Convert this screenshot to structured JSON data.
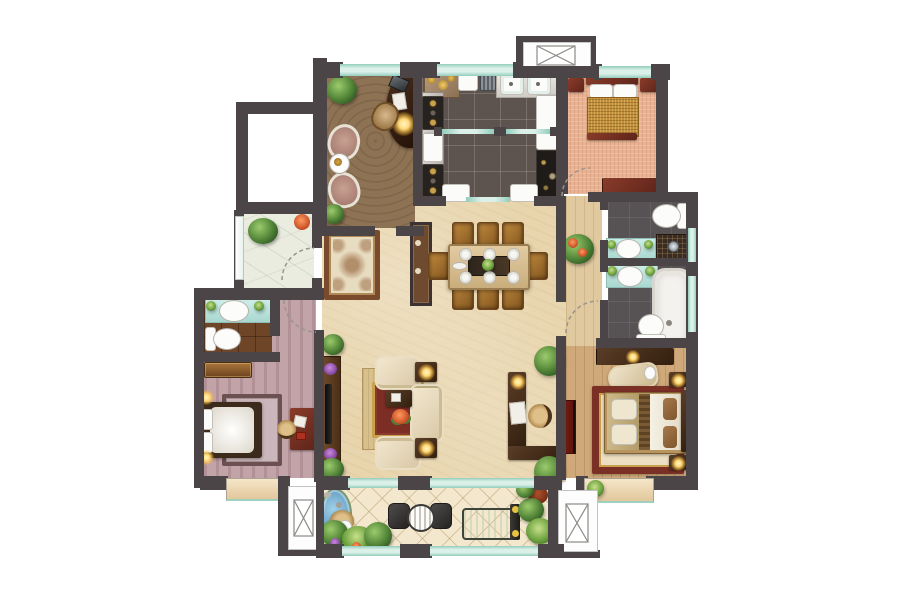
{
  "document": {
    "type": "residential-floor-plan",
    "description": "Top-down rendered 3-bedroom apartment floor plan, unlabeled, white background",
    "canvas": {
      "width": 900,
      "height": 600
    }
  },
  "colors": {
    "wall": "#4b4547",
    "glass": "#daf0e8",
    "glassEdge": "#93cdbd",
    "living": "#e8d5ad",
    "hall": "#e0c99e",
    "carpet": "#8e7254",
    "kitchen": "#5d5450",
    "bed1": "#e8b393",
    "bath": "#575254",
    "lbed": "#c2a3a8",
    "lbath": "#6f4527",
    "master": "#cfa97a",
    "patio": "#e9ecdf",
    "balcony": "#f3e8cd",
    "platform": "#c6c6c8",
    "maroon": "#7c3526",
    "wood": "#4a3320",
    "cream": "#eee2c8",
    "gold": "#c18f3a",
    "rugRed": "#7c2d24",
    "rugGold": "#c9a14c",
    "teal": "#c5e9e2",
    "water": "#5f9cc4",
    "glow": "#ffd978",
    "plant": "#4e8135"
  },
  "rooms": [
    {
      "name": "study",
      "items": [
        "curved-desk",
        "desk-chair",
        "laptop",
        "desk-lamp",
        "lounge-chair",
        "lounge-chair",
        "tea-table",
        "potted-palm"
      ]
    },
    {
      "name": "kitchen",
      "items": [
        "gas-stove",
        "gas-stove",
        "double-sink",
        "coffee-station",
        "white-cabinets",
        "marble-counter",
        "sliding-double-door",
        "glass-partition"
      ]
    },
    {
      "name": "bedroom-north",
      "items": [
        "double-bed-gold",
        "nightstand",
        "nightstand",
        "dresser",
        "swing-door"
      ]
    },
    {
      "name": "bathroom-guest",
      "items": [
        "toilet",
        "washbasin-vanity",
        "shower-corner",
        "window"
      ]
    },
    {
      "name": "bathroom-master",
      "items": [
        "bathtub",
        "washbasin-vanity",
        "toilet",
        "window"
      ]
    },
    {
      "name": "hallway",
      "items": [
        "potted-rose",
        "swing-door"
      ]
    },
    {
      "name": "master-bedroom",
      "items": [
        "double-bed",
        "nightstand-lamp",
        "nightstand-lamp",
        "wardrobe",
        "chaise-lounge",
        "wall-tv",
        "ornate-rug",
        "bay-window",
        "bay-plant"
      ]
    },
    {
      "name": "bedroom-west",
      "items": [
        "double-bed",
        "area-rug",
        "writing-desk",
        "wicker-chair",
        "dresser",
        "wall-lamp",
        "wall-lamp",
        "bay-window",
        "swing-door"
      ]
    },
    {
      "name": "bathroom-west-ensuite",
      "items": [
        "toilet",
        "washbasin-vanity"
      ]
    },
    {
      "name": "living-room",
      "items": [
        "three-seat-sofa",
        "armchair",
        "armchair",
        "coffee-table",
        "red-gold-rug",
        "lamp-table",
        "lamp-table",
        "tv-console",
        "tv",
        "corner-desk",
        "wicker-chair",
        "potted-palm",
        "potted-palm",
        "flower-pot",
        "flower-pot"
      ]
    },
    {
      "name": "dining-area",
      "items": [
        "dining-table",
        "dining-chairs-8",
        "place-settings-6",
        "centerpiece-plant",
        "divider-screen"
      ]
    },
    {
      "name": "entry-foyer",
      "items": [
        "ornate-entry-rug",
        "potted-plant",
        "entry-door"
      ]
    },
    {
      "name": "patio-terrace",
      "items": [
        "potted-palm",
        "potted-flower",
        "window-strip"
      ]
    },
    {
      "name": "equipment-platform",
      "items": []
    },
    {
      "name": "south-balcony",
      "items": [
        "garden-pond",
        "wicker-lounge-chair",
        "bistro-chair",
        "bistro-chair",
        "bistro-table",
        "treadmill",
        "garden-plants",
        "glazed-railing"
      ]
    },
    {
      "name": "ac-platform-north",
      "items": [
        "ac-unit-symbol"
      ]
    },
    {
      "name": "ac-platform-southwest",
      "items": [
        "ac-unit-symbol"
      ]
    },
    {
      "name": "ac-platform-southeast",
      "items": [
        "ac-unit-symbol"
      ]
    }
  ]
}
